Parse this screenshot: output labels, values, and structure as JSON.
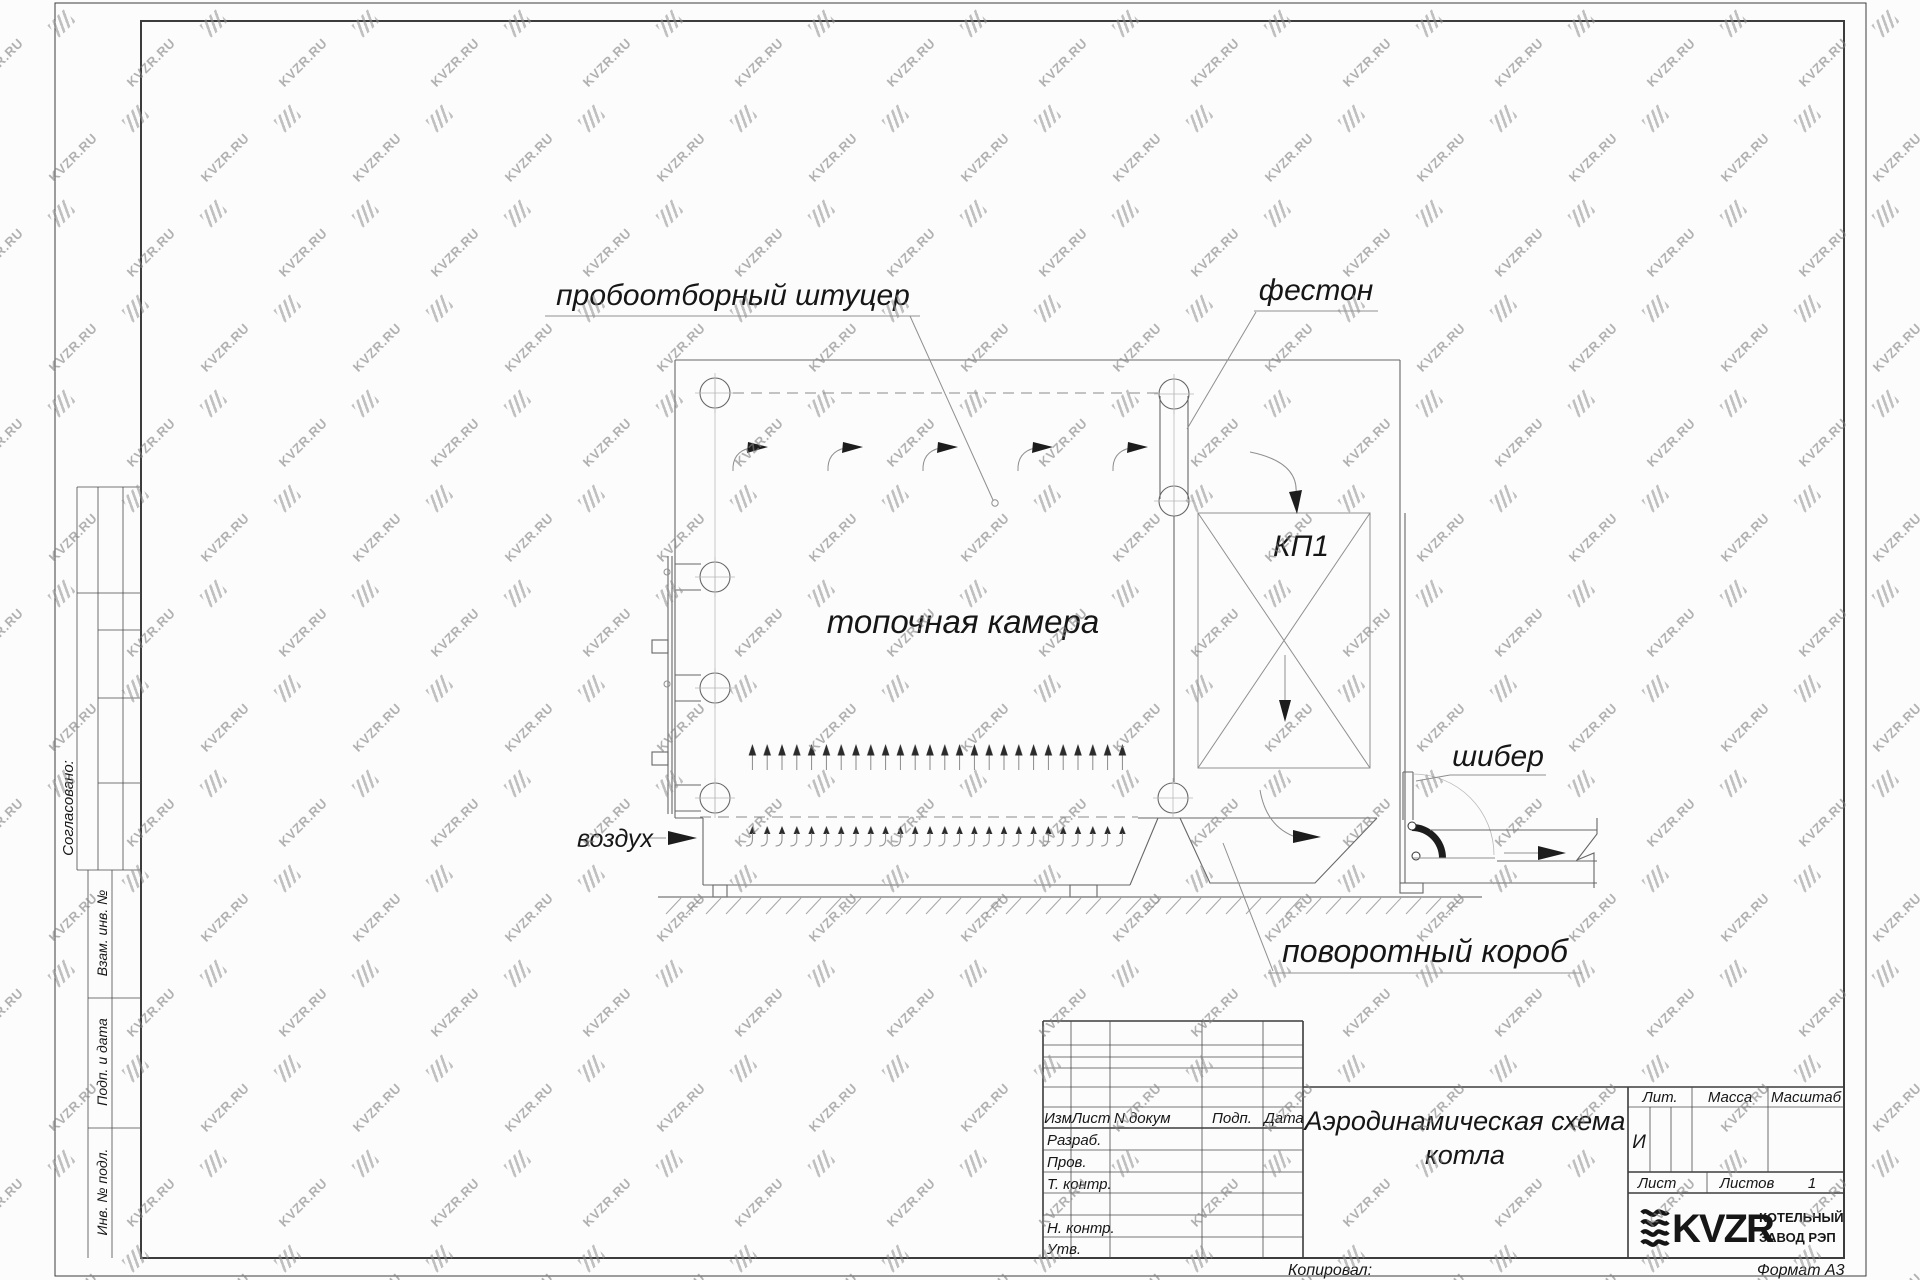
{
  "watermark": {
    "text": "KVZR.RU"
  },
  "drawing": {
    "labels": {
      "sampling_port": "пробоотборный штуцер",
      "festoon": "фестон",
      "furnace_chamber": "топочная камера",
      "kp1": "КП1",
      "damper": "шибер",
      "air": "воздух",
      "turning_duct": "поворотный короб"
    }
  },
  "side_column": {
    "agreed": "Согласовано:",
    "replacement_inv": "Взам. инв. №",
    "sign_date": "Подп. и дата",
    "inv_orig": "Инв. № подл."
  },
  "title_block": {
    "columns": {
      "izm": "Изм",
      "list": "Лист",
      "doc": "N докум",
      "sign": "Подп.",
      "date": "Дата"
    },
    "rows": {
      "developed": "Разраб.",
      "checked": "Пров.",
      "t_control": "Т. контр.",
      "n_control": "Н. контр.",
      "approved": "Утв."
    },
    "title_line1": "Аэродинамическая схема",
    "title_line2": "котла",
    "lit_label": "Лит.",
    "lit_value": "И",
    "mass_label": "Масса",
    "scale_label": "Масштаб",
    "sheet_label": "Лист",
    "sheets_label": "Листов",
    "sheets_value": "1",
    "company": {
      "logo_text": "KVZR",
      "line1": "КОТЕЛЬНЫЙ",
      "line2": "ЗАВОД РЭП"
    },
    "copied_by": "Копировал:",
    "format": "Формат А3"
  }
}
